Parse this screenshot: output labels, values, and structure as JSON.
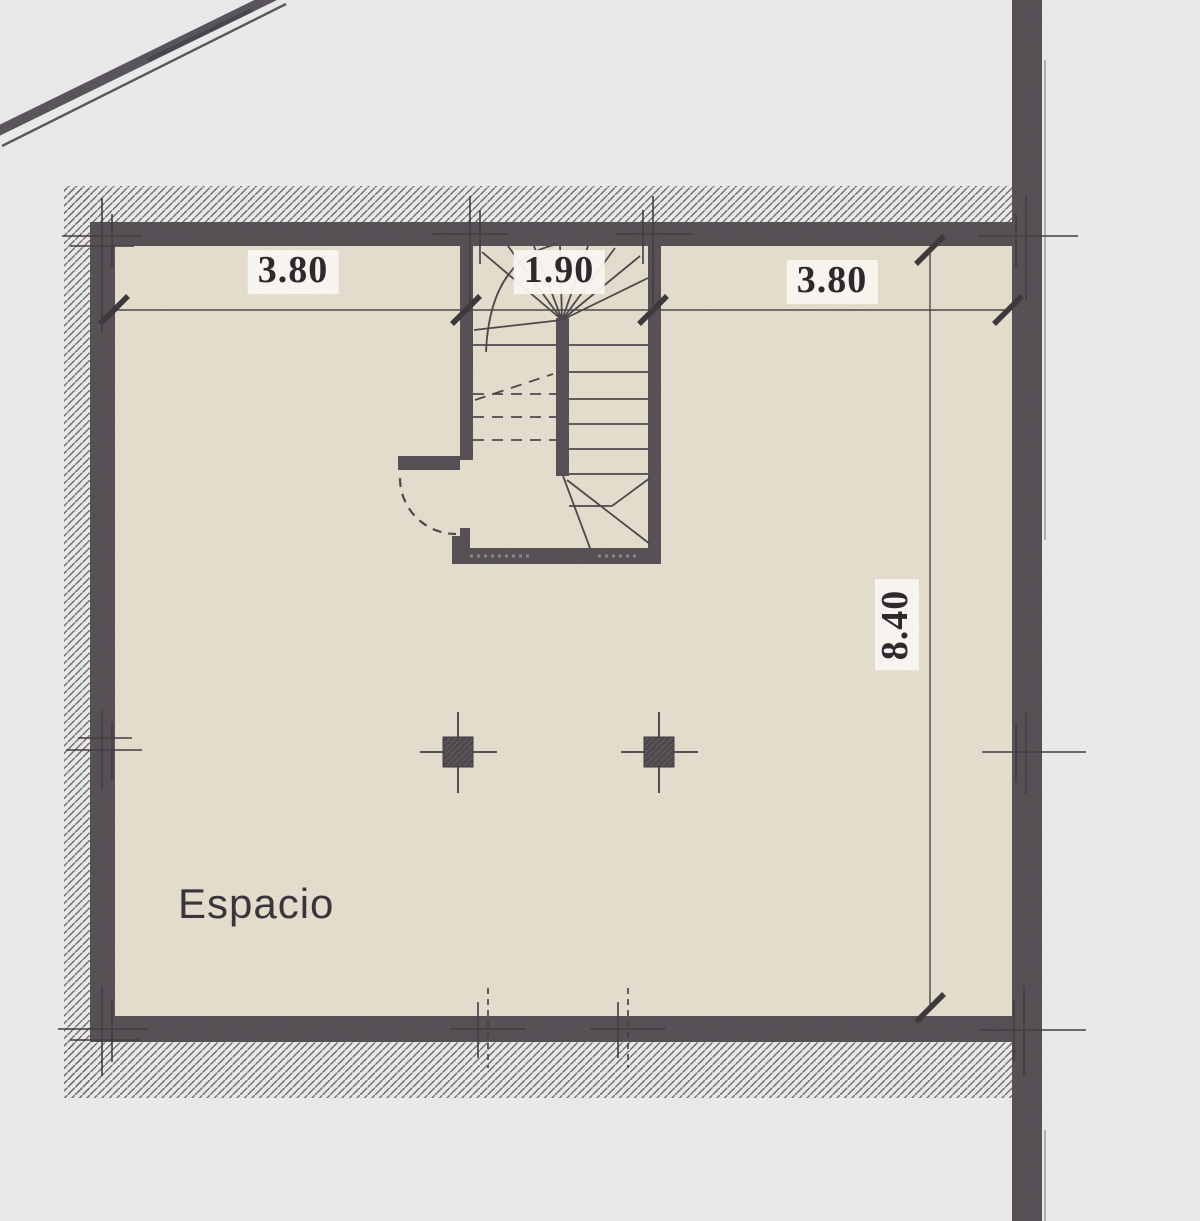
{
  "plan": {
    "room": {
      "label": "Espacio"
    },
    "dimensions": {
      "top_left": "3.80",
      "top_center": "1.90",
      "top_right": "3.80",
      "right_vertical": "8.40"
    },
    "elements": {
      "staircase": "winder-staircase",
      "columns": 2,
      "door": "door-swing-arc",
      "wall_border": "hatched-exterior-band"
    },
    "colors": {
      "background": "#eaece9",
      "floor": "#e5decd",
      "wall": "#544e53",
      "hatch_line": "#6f6a72",
      "drawing_line": "#4a4549",
      "label_background": "#f8f6f0",
      "text": "#2e292d"
    }
  }
}
